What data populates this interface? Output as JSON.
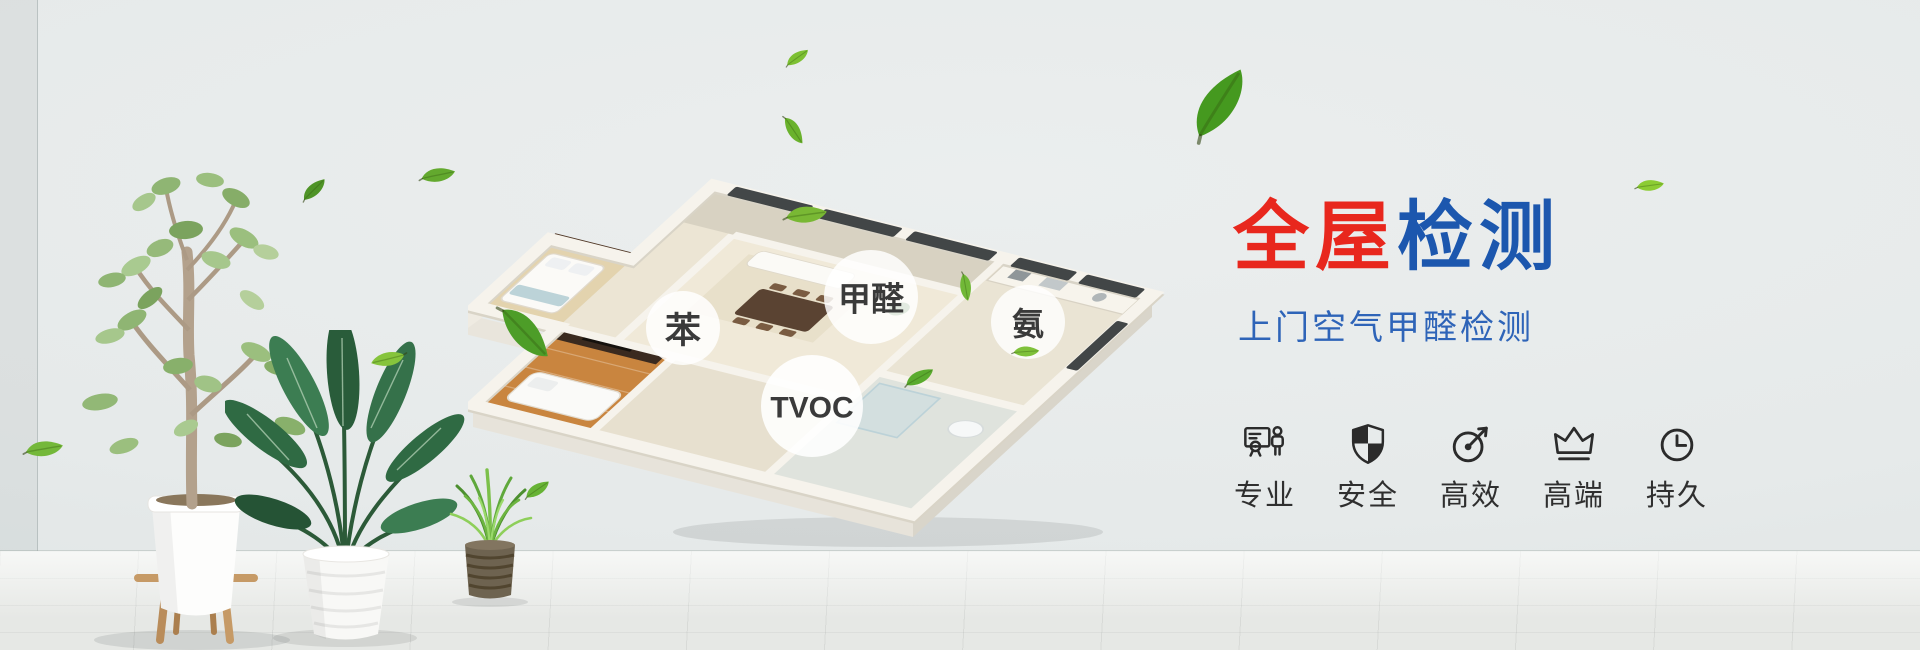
{
  "banner": {
    "title": {
      "text_red": "全屋",
      "text_blue": "检测"
    },
    "subtitle": "上门空气甲醛检测",
    "pollutant_labels": [
      {
        "name": "benzene",
        "text": "苯"
      },
      {
        "name": "formaldehyde",
        "text": "甲醛"
      },
      {
        "name": "ammonia",
        "text": "氨"
      },
      {
        "name": "tvoc",
        "text": "TVOC"
      }
    ],
    "features": [
      {
        "icon": "certificate-person-icon",
        "label": "专业"
      },
      {
        "icon": "shield-icon",
        "label": "安全"
      },
      {
        "icon": "gauge-icon",
        "label": "高效"
      },
      {
        "icon": "crown-icon",
        "label": "高端"
      },
      {
        "icon": "clock-icon",
        "label": "持久"
      }
    ],
    "colors": {
      "title_red": "#e8271d",
      "title_blue": "#1c57ae",
      "subtitle_blue": "#2e64b8",
      "leaf_green": "#6ab82d",
      "icon_color": "#2b2b2b"
    }
  }
}
